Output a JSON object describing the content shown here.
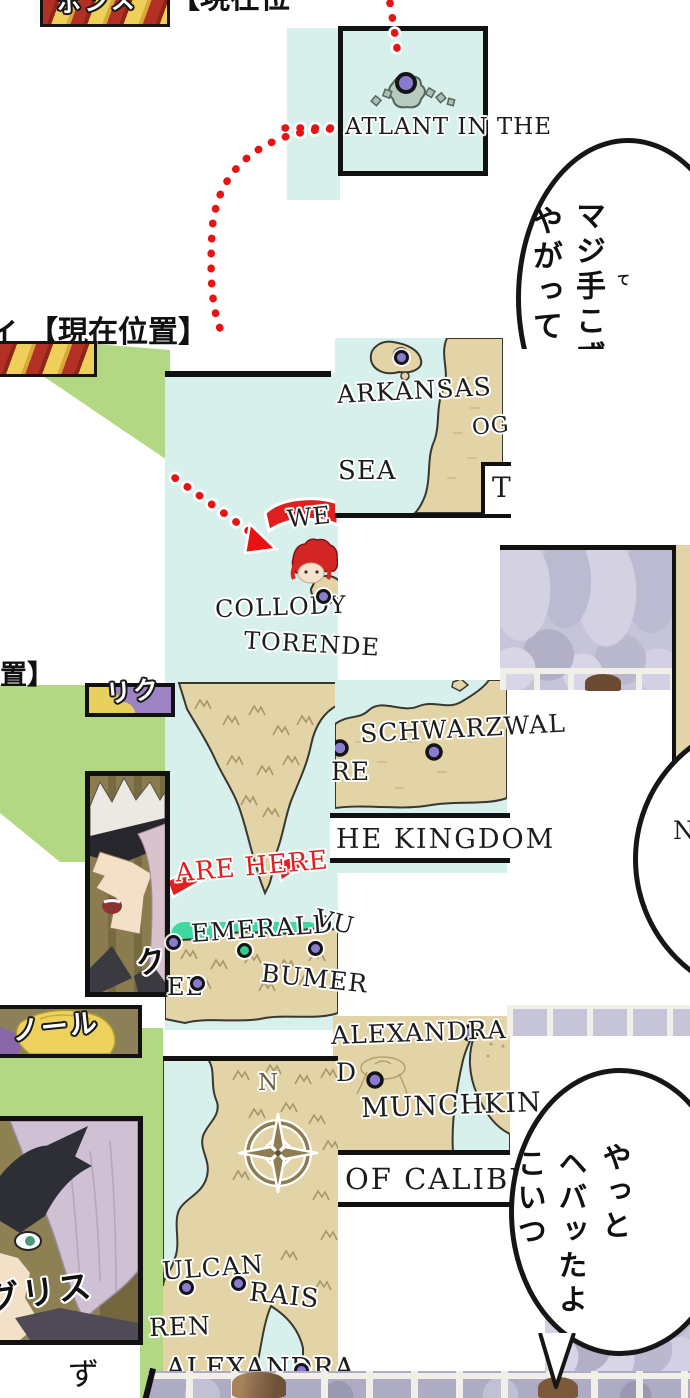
{
  "titles": {
    "current_top": "【現在位",
    "current_mid_prefix": "イ",
    "current_mid": "【現在位置】",
    "current_fragment": "置】",
    "banner_top_text": "ボンス"
  },
  "map": {
    "atlant": "ATLANT IN THE",
    "arkansas": "ARKANSAS",
    "sea": "SEA",
    "og_fragment": "OG",
    "t_fragment": "T",
    "we": "WE",
    "are_here": "ARE HERE",
    "collody": "COLLODY",
    "torende": "TORENDE",
    "schwarzwald": "SCHWARZWAL",
    "re_fragment": "RE",
    "kingdom_fragment": "HE KINGDOM",
    "emerald": "EMERALD",
    "vu_fragment": "VU",
    "bumer_fragment": "BUMER",
    "el_fragment": "EL",
    "alexandra_upper": "ALEXANDRA",
    "d_fragment": "D",
    "munchkin": "MUNCHKIN",
    "caliburn_fragment": "OF CALIBURN",
    "vulcan_fragment": "ULCAN",
    "rais": "RAIS",
    "ren_fragment": "REN",
    "alexandra_lower": "ALEXANDRA",
    "n_fragment": "N",
    "compass_north": "N",
    "ku_fragment": "ク"
  },
  "bubbles": {
    "top_col_right": "マジ手こず",
    "top_furigana": "て",
    "top_col_left": "やがって",
    "bottom_col_right": "やっと",
    "bottom_col_mid": "ヘバッたよ",
    "bottom_col_left": "こいつ"
  },
  "characters": {
    "riku": "リク",
    "noru": "ノール",
    "gurisu": "グリス",
    "zu_fragment": "ず"
  },
  "colors": {
    "sea": "#d8f0ec",
    "land": "#e2d4a6",
    "green_bg": "#b3d884",
    "red_dot": "#e81212",
    "purple_marker": "#8a7ad0",
    "green_marker": "#2ecc8e",
    "emerald_band": "#3fd9a0",
    "banner_red": "#b23124",
    "banner_yellow": "#eecf5a",
    "crowd": "#c6c4d8"
  }
}
